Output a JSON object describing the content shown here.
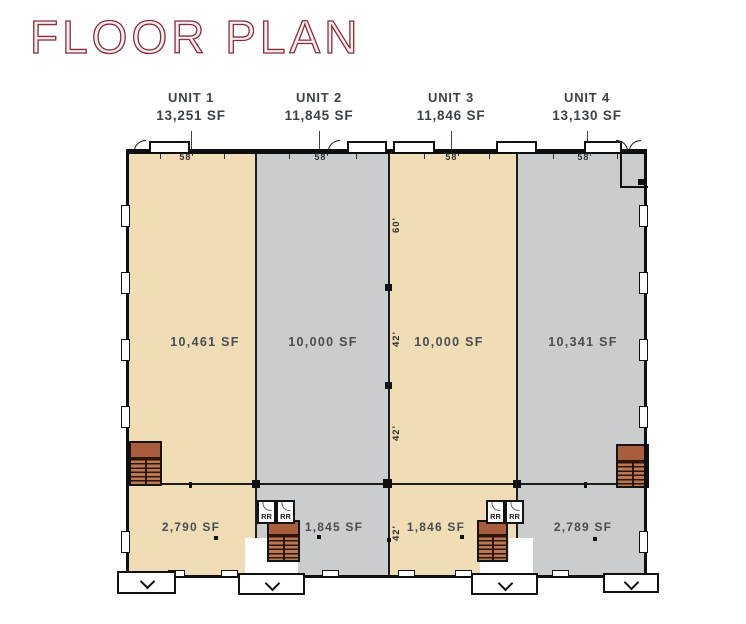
{
  "title": "FLOOR PLAN",
  "units": [
    {
      "name": "UNIT 1",
      "total_sf": "13,251 SF",
      "top_dim": "58'",
      "main_sf": "10,461 SF",
      "lower_sf": "2,790 SF"
    },
    {
      "name": "UNIT 2",
      "total_sf": "11,845 SF",
      "top_dim": "58'",
      "main_sf": "10,000 SF",
      "lower_sf": "1,845 SF"
    },
    {
      "name": "UNIT 3",
      "total_sf": "11,846 SF",
      "top_dim": "58'",
      "main_sf": "10,000 SF",
      "lower_sf": "1,846 SF"
    },
    {
      "name": "UNIT 4",
      "total_sf": "13,130 SF",
      "top_dim": "58'",
      "main_sf": "10,341 SF",
      "lower_sf": "2,789 SF"
    }
  ],
  "center_dims": [
    "60'",
    "42'",
    "42'",
    "42'"
  ],
  "restroom_label": "RR",
  "colors": {
    "title": "#8b2a3a",
    "unit_fill_tan": "#f0ddb5",
    "unit_fill_gray": "#cbcccd",
    "stair_fill": "#b06845",
    "wall": "#111111",
    "label_text": "#3f4245"
  }
}
